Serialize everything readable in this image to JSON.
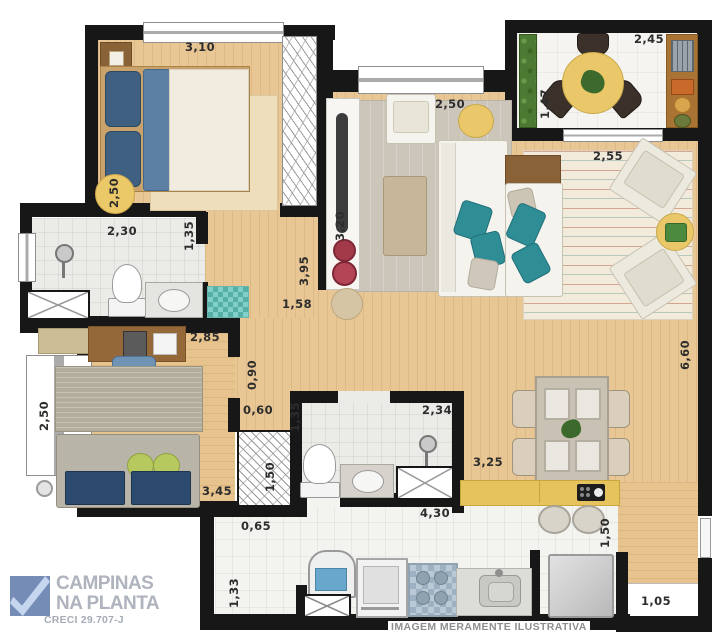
{
  "logo": {
    "name_line1": "CAMPINAS",
    "name_line2": "NA PLANTA",
    "creci": "CRECI 29.707-J"
  },
  "footer": {
    "disclaimer": "IMAGEM MERAMENTE ILUSTRATIVA"
  },
  "colors": {
    "wall": "#171717",
    "wood_floor": "#e9c795",
    "bath_tile": "#ebebe8",
    "kitchen_tile": "#f3f3f0",
    "counter_yellow": "#e6c35c",
    "accent_teal": "#2f8d95",
    "accent_navy": "#3f6080",
    "dim_circle_yellow": "#ecc968",
    "garden_green": "#4c7a33"
  },
  "dimensions": [
    {
      "id": "bedroom-width",
      "value": "3,10"
    },
    {
      "id": "bedroom-depth",
      "value": "2,50"
    },
    {
      "id": "bath1-width",
      "value": "2,30"
    },
    {
      "id": "bath1-depth",
      "value": "1,35"
    },
    {
      "id": "living-width",
      "value": "2,50"
    },
    {
      "id": "balcony-width",
      "value": "2,45"
    },
    {
      "id": "balcony-depth",
      "value": "1,47"
    },
    {
      "id": "lounge-width",
      "value": "2,55"
    },
    {
      "id": "right-side-length",
      "value": "6,60"
    },
    {
      "id": "tv-wall-length",
      "value": "3,20"
    },
    {
      "id": "living-wall-length",
      "value": "3,95"
    },
    {
      "id": "nook-width",
      "value": "1,58"
    },
    {
      "id": "office-width",
      "value": "2,85"
    },
    {
      "id": "office-depth",
      "value": "2,50"
    },
    {
      "id": "office-length",
      "value": "3,45"
    },
    {
      "id": "hall-width",
      "value": "0,90"
    },
    {
      "id": "closet-width",
      "value": "0,60"
    },
    {
      "id": "closet-depth",
      "value": "1,50"
    },
    {
      "id": "bath2-depth",
      "value": "1,35"
    },
    {
      "id": "bath2-width",
      "value": "2,34"
    },
    {
      "id": "dining-width",
      "value": "3,25"
    },
    {
      "id": "kitchen-width",
      "value": "4,30"
    },
    {
      "id": "kitchen-depth",
      "value": "1,50"
    },
    {
      "id": "service-width",
      "value": "0,65"
    },
    {
      "id": "service-depth",
      "value": "1,33"
    },
    {
      "id": "entry-nook-width",
      "value": "1,05"
    }
  ]
}
